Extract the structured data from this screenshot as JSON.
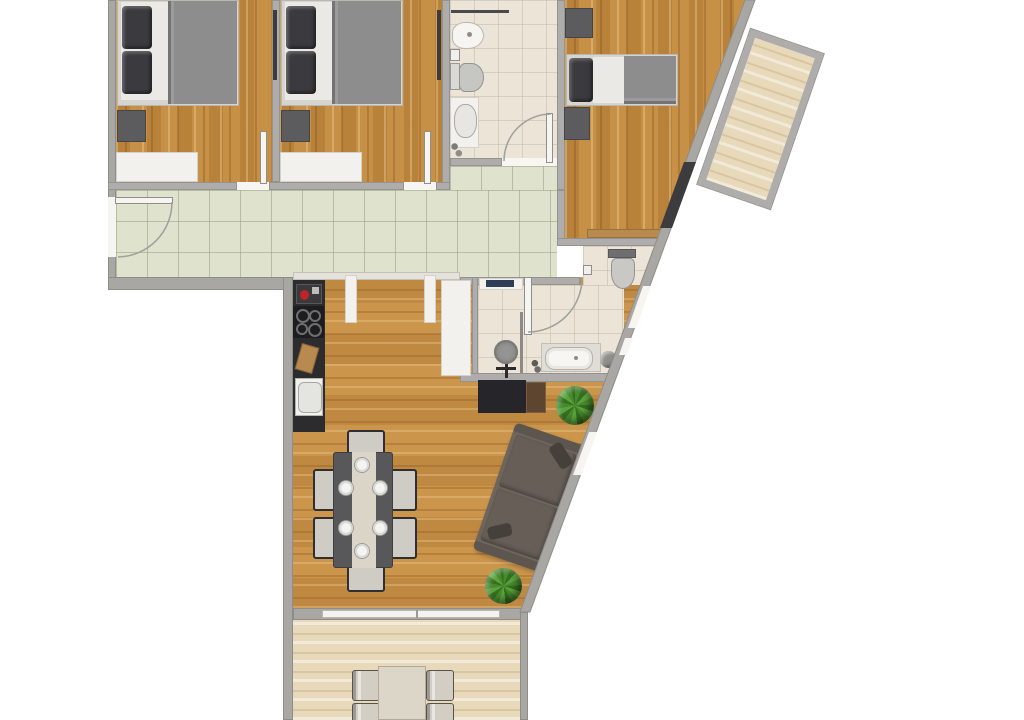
{
  "document": {
    "kind": "apartment floor plan, top-down rendered view, no text labels visible"
  },
  "palette": {
    "background": "#ffffff",
    "wall_gray": "#aeadab",
    "wall_outline": "#94938e",
    "oak_floor": "#c18a41",
    "living_floor": "#c79147",
    "pale_plank_floor": "#e7d9ba",
    "hallway_tile": "#dfe3ce",
    "bathroom_tile": "#ebe4d7",
    "dark_furniture": "#5c5c5e",
    "bed_blanket": "#8d8d8d",
    "pillow_dark": "#3b3b3f",
    "kitchen_counter": "#2c2c2f",
    "dining_table": "#58585b",
    "table_runner": "#dbd5c7",
    "sofa": "#6e655d",
    "plant_green": "#47892e",
    "wood_accent": "#b98a50",
    "monitor_blue": "#2e3d58",
    "appliance_red": "#c0232a"
  },
  "floor_plan": {
    "rooms": [
      {
        "name": "bedroom-1",
        "floor": "oak-wood",
        "furniture": [
          "double-bed",
          "dark-pillows",
          "nightstand",
          "white-dresser",
          "open-door"
        ]
      },
      {
        "name": "bedroom-2",
        "floor": "oak-wood",
        "furniture": [
          "double-bed",
          "dark-pillows",
          "nightstand",
          "white-dresser",
          "open-door"
        ]
      },
      {
        "name": "bathroom-top",
        "floor": "cream-tile",
        "fixtures": [
          "bidet",
          "toilet",
          "vanity-sink",
          "shower-screen",
          "swing-door"
        ]
      },
      {
        "name": "bedroom-3",
        "floor": "oak-wood",
        "furniture": [
          "single-bed",
          "two-nightstands",
          "sideboard",
          "balcony-door"
        ]
      },
      {
        "name": "balcony",
        "floor": "pale-wood-planks",
        "shape": "rotated-rectangle"
      },
      {
        "name": "hallway",
        "floor": "green-tile-grid",
        "fixtures": [
          "entrance-door-with-swing"
        ]
      },
      {
        "name": "kitchen-living-dining",
        "floor": "honey-oak",
        "furniture": [
          "kitchen-counter",
          "coffee-machine",
          "cooktop-4-burners",
          "cutting-board",
          "kitchen-sink",
          "white-cabinets",
          "wardrobe",
          "dining-table-runner",
          "desk",
          "sofa",
          "plants"
        ]
      },
      {
        "name": "study-nook",
        "floor": "cream-tile",
        "furniture": [
          "desk-with-monitor",
          "office-chair"
        ]
      },
      {
        "name": "bathroom-middle",
        "floor": "cream-tile",
        "fixtures": [
          "toilet",
          "bathtub",
          "round-stool",
          "swing-door",
          "windows-on-diagonal-wall"
        ]
      },
      {
        "name": "terrace",
        "floor": "pale-wood-planks",
        "furniture": [
          "outdoor-table",
          "four-chairs"
        ]
      }
    ],
    "counts": {
      "dining_chairs": 6,
      "dining_plates": 6,
      "cooktop_burners": 4,
      "terrace_chairs": 4,
      "plants": 2,
      "bedrooms": 3,
      "bathrooms": 2
    },
    "geometry_notes": "right exterior wall runs diagonally from top-right to lower-middle; balcony rotated ~19deg attached outside top-right"
  }
}
